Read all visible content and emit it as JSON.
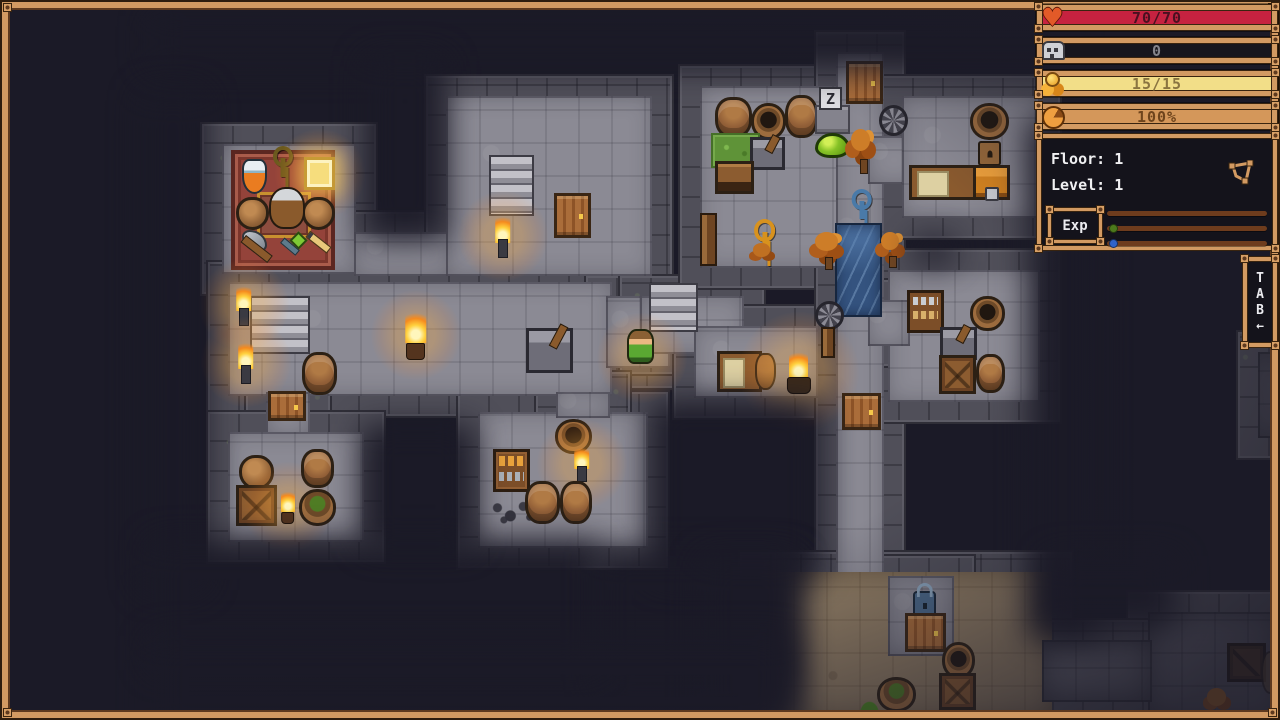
{
  "hud": {
    "bars": [
      {
        "id": "health-bar",
        "icon": "heart-icon",
        "label": "70/70",
        "fill": "#c62240",
        "text": "#4a1020"
      },
      {
        "id": "skull-bar",
        "icon": "skull-icon",
        "label": "0",
        "fill": "#17161d",
        "text": "#84848a"
      },
      {
        "id": "gold-bar",
        "icon": "coins-icon",
        "label": "15/15",
        "fill": "#f2de88",
        "text": "#8a7440"
      },
      {
        "id": "satiety-bar",
        "icon": "food-icon",
        "label": "100%",
        "fill": "#d4975a",
        "text": "#6e441c"
      }
    ],
    "info": {
      "floor": "Floor: 1",
      "level": "Level: 1",
      "exp": "Exp",
      "exp_rows": [
        {
          "dot": null
        },
        {
          "dot": "#4c7a1c"
        },
        {
          "dot": "#2f63c9"
        }
      ]
    },
    "tab": {
      "letters": [
        "T",
        "A",
        "B"
      ],
      "arrow": "←"
    }
  },
  "map": {
    "floors": [
      {
        "x": 222,
        "y": 144,
        "w": 134,
        "h": 130,
        "tone": "light"
      },
      {
        "x": 354,
        "y": 232,
        "w": 96,
        "h": 44,
        "tone": "light"
      },
      {
        "x": 446,
        "y": 96,
        "w": 206,
        "h": 180,
        "tone": "light"
      },
      {
        "x": 228,
        "y": 282,
        "w": 384,
        "h": 114,
        "tone": "light"
      },
      {
        "x": 266,
        "y": 392,
        "w": 44,
        "h": 44,
        "tone": "light"
      },
      {
        "x": 228,
        "y": 432,
        "w": 136,
        "h": 110,
        "tone": "light"
      },
      {
        "x": 606,
        "y": 296,
        "w": 64,
        "h": 72,
        "tone": "light"
      },
      {
        "x": 640,
        "y": 296,
        "w": 104,
        "h": 58,
        "tone": "light"
      },
      {
        "x": 694,
        "y": 326,
        "w": 124,
        "h": 72,
        "tone": "light"
      },
      {
        "x": 700,
        "y": 86,
        "w": 170,
        "h": 182,
        "tone": "light"
      },
      {
        "x": 836,
        "y": 52,
        "w": 48,
        "h": 544,
        "tone": "light"
      },
      {
        "x": 868,
        "y": 136,
        "w": 52,
        "h": 48,
        "tone": "light"
      },
      {
        "x": 902,
        "y": 96,
        "w": 138,
        "h": 122,
        "tone": "light"
      },
      {
        "x": 888,
        "y": 270,
        "w": 152,
        "h": 132,
        "tone": "light"
      },
      {
        "x": 868,
        "y": 300,
        "w": 42,
        "h": 46,
        "tone": "light"
      },
      {
        "x": 478,
        "y": 412,
        "w": 170,
        "h": 136,
        "tone": "light"
      },
      {
        "x": 556,
        "y": 392,
        "w": 54,
        "h": 26,
        "tone": "light"
      },
      {
        "x": 760,
        "y": 572,
        "w": 292,
        "h": 148,
        "tone": "dirt"
      },
      {
        "x": 888,
        "y": 576,
        "w": 66,
        "h": 80,
        "tone": "light"
      },
      {
        "x": 1148,
        "y": 612,
        "w": 132,
        "h": 108,
        "tone": "dim"
      },
      {
        "x": 1042,
        "y": 640,
        "w": 110,
        "h": 62,
        "tone": "dim"
      },
      {
        "x": 1258,
        "y": 352,
        "w": 22,
        "h": 86,
        "tone": "dim"
      }
    ],
    "objects": [
      {
        "type": "carpet",
        "x": 231,
        "y": 150,
        "w": 104,
        "h": 120
      },
      {
        "type": "mat",
        "x": 257,
        "y": 192,
        "w": 54,
        "h": 46
      },
      {
        "type": "keydark",
        "x": 272,
        "y": 146,
        "w": 22,
        "h": 32
      },
      {
        "type": "potion",
        "x": 242,
        "y": 159,
        "w": 25,
        "h": 35
      },
      {
        "type": "book",
        "x": 304,
        "y": 157,
        "w": 31,
        "h": 33
      },
      {
        "type": "pot",
        "x": 236,
        "y": 197,
        "w": 33,
        "h": 33
      },
      {
        "type": "pot",
        "x": 302,
        "y": 197,
        "w": 33,
        "h": 33
      },
      {
        "type": "npc",
        "x": 269,
        "y": 187,
        "w": 36,
        "h": 42
      },
      {
        "type": "axe",
        "x": 242,
        "y": 230,
        "w": 35,
        "h": 33
      },
      {
        "type": "wand",
        "x": 278,
        "y": 234,
        "w": 25,
        "h": 29
      },
      {
        "type": "pencil",
        "x": 304,
        "y": 232,
        "w": 29,
        "h": 31
      },
      {
        "type": "stairs",
        "x": 250,
        "y": 296,
        "w": 60,
        "h": 58
      },
      {
        "type": "torch",
        "x": 233,
        "y": 283,
        "w": 21,
        "h": 43
      },
      {
        "type": "torch",
        "x": 235,
        "y": 339,
        "w": 21,
        "h": 45
      },
      {
        "type": "candle",
        "x": 401,
        "y": 309,
        "w": 29,
        "h": 51
      },
      {
        "type": "lever",
        "x": 526,
        "y": 328,
        "w": 47,
        "h": 45
      },
      {
        "type": "barrel",
        "x": 302,
        "y": 352,
        "w": 35,
        "h": 43
      },
      {
        "type": "door",
        "x": 268,
        "y": 391,
        "w": 38,
        "h": 30
      },
      {
        "type": "pot",
        "x": 239,
        "y": 455,
        "w": 35,
        "h": 35
      },
      {
        "type": "crate2",
        "x": 236,
        "y": 485,
        "w": 41,
        "h": 41
      },
      {
        "type": "candle",
        "x": 278,
        "y": 489,
        "w": 19,
        "h": 35
      },
      {
        "type": "barrel",
        "x": 301,
        "y": 449,
        "w": 33,
        "h": 39
      },
      {
        "type": "potplant",
        "x": 299,
        "y": 489,
        "w": 37,
        "h": 37
      },
      {
        "type": "stairs",
        "x": 489,
        "y": 155,
        "w": 45,
        "h": 61
      },
      {
        "type": "door",
        "x": 554,
        "y": 193,
        "w": 37,
        "h": 45
      },
      {
        "type": "torch",
        "x": 492,
        "y": 213,
        "w": 21,
        "h": 45
      },
      {
        "type": "barrel",
        "x": 715,
        "y": 97,
        "w": 37,
        "h": 41
      },
      {
        "type": "potopen",
        "x": 751,
        "y": 103,
        "w": 35,
        "h": 37
      },
      {
        "type": "barrel",
        "x": 785,
        "y": 95,
        "w": 33,
        "h": 43
      },
      {
        "type": "grass",
        "x": 711,
        "y": 133,
        "w": 49,
        "h": 35
      },
      {
        "type": "lever",
        "x": 750,
        "y": 137,
        "w": 35,
        "h": 33
      },
      {
        "type": "chestwood",
        "x": 715,
        "y": 161,
        "w": 39,
        "h": 33
      },
      {
        "type": "slab",
        "x": 815,
        "y": 105,
        "w": 35,
        "h": 29
      },
      {
        "type": "zsign",
        "x": 819,
        "y": 87,
        "w": 23,
        "h": 23,
        "label": "Z"
      },
      {
        "type": "slime",
        "x": 815,
        "y": 133,
        "w": 35,
        "h": 25
      },
      {
        "type": "tree",
        "x": 843,
        "y": 125,
        "w": 37,
        "h": 49
      },
      {
        "type": "door",
        "x": 846,
        "y": 61,
        "w": 37,
        "h": 43
      },
      {
        "type": "windmill",
        "x": 879,
        "y": 105,
        "w": 29,
        "h": 31
      },
      {
        "type": "post",
        "x": 700,
        "y": 213,
        "w": 17,
        "h": 53
      },
      {
        "type": "keygold",
        "x": 752,
        "y": 219,
        "w": 25,
        "h": 35
      },
      {
        "type": "bush",
        "x": 744,
        "y": 239,
        "w": 35,
        "h": 27
      },
      {
        "type": "keyblue",
        "x": 850,
        "y": 189,
        "w": 23,
        "h": 31
      },
      {
        "type": "water",
        "x": 835,
        "y": 223,
        "w": 47,
        "h": 94
      },
      {
        "type": "tree",
        "x": 805,
        "y": 229,
        "w": 45,
        "h": 41
      },
      {
        "type": "tree",
        "x": 873,
        "y": 229,
        "w": 35,
        "h": 39
      },
      {
        "type": "potopen",
        "x": 970,
        "y": 103,
        "w": 39,
        "h": 37
      },
      {
        "type": "chestsmall",
        "x": 978,
        "y": 141,
        "w": 23,
        "h": 25
      },
      {
        "type": "bench",
        "x": 909,
        "y": 165,
        "w": 69,
        "h": 35
      },
      {
        "type": "chest",
        "x": 973,
        "y": 165,
        "w": 37,
        "h": 35
      },
      {
        "type": "bookshelf",
        "x": 907,
        "y": 290,
        "w": 37,
        "h": 43
      },
      {
        "type": "potopen",
        "x": 970,
        "y": 296,
        "w": 35,
        "h": 35
      },
      {
        "type": "lever",
        "x": 940,
        "y": 327,
        "w": 37,
        "h": 33
      },
      {
        "type": "crate2",
        "x": 939,
        "y": 355,
        "w": 37,
        "h": 39
      },
      {
        "type": "barrel",
        "x": 976,
        "y": 354,
        "w": 29,
        "h": 39
      },
      {
        "type": "stairs",
        "x": 649,
        "y": 283,
        "w": 49,
        "h": 49
      },
      {
        "type": "glowitem",
        "x": 631,
        "y": 351,
        "w": 21,
        "h": 13
      },
      {
        "type": "player",
        "x": 627,
        "y": 329,
        "w": 27,
        "h": 35
      },
      {
        "type": "bench",
        "x": 717,
        "y": 351,
        "w": 45,
        "h": 41
      },
      {
        "type": "jug",
        "x": 755,
        "y": 353,
        "w": 21,
        "h": 37
      },
      {
        "type": "brazier",
        "x": 785,
        "y": 349,
        "w": 27,
        "h": 45
      },
      {
        "type": "windmill",
        "x": 815,
        "y": 301,
        "w": 29,
        "h": 29
      },
      {
        "type": "post",
        "x": 821,
        "y": 327,
        "w": 14,
        "h": 31
      },
      {
        "type": "door",
        "x": 842,
        "y": 393,
        "w": 39,
        "h": 37
      },
      {
        "type": "potopen",
        "x": 555,
        "y": 419,
        "w": 37,
        "h": 35
      },
      {
        "type": "torch",
        "x": 571,
        "y": 445,
        "w": 21,
        "h": 37
      },
      {
        "type": "shelf",
        "x": 493,
        "y": 449,
        "w": 37,
        "h": 43
      },
      {
        "type": "rubble",
        "x": 491,
        "y": 497,
        "w": 43,
        "h": 27
      },
      {
        "type": "barrel",
        "x": 525,
        "y": 481,
        "w": 35,
        "h": 43
      },
      {
        "type": "barrel",
        "x": 560,
        "y": 481,
        "w": 32,
        "h": 43
      },
      {
        "type": "padlock",
        "x": 913,
        "y": 591,
        "w": 23,
        "h": 27
      },
      {
        "type": "door",
        "x": 905,
        "y": 613,
        "w": 41,
        "h": 39
      },
      {
        "type": "potopen",
        "x": 942,
        "y": 642,
        "w": 33,
        "h": 37
      },
      {
        "type": "crate2",
        "x": 939,
        "y": 673,
        "w": 37,
        "h": 37
      },
      {
        "type": "potplant",
        "x": 877,
        "y": 677,
        "w": 39,
        "h": 35
      },
      {
        "type": "tuft",
        "x": 858,
        "y": 699,
        "w": 23,
        "h": 15
      },
      {
        "type": "tuft",
        "x": 938,
        "y": 711,
        "w": 25,
        "h": 9
      },
      {
        "type": "cratedark",
        "x": 1227,
        "y": 643,
        "w": 39,
        "h": 39
      },
      {
        "type": "bush",
        "x": 1197,
        "y": 683,
        "w": 39,
        "h": 35
      },
      {
        "type": "potdim",
        "x": 1261,
        "y": 651,
        "w": 19,
        "h": 43
      }
    ],
    "fog": [
      {
        "x": 150,
        "y": 16,
        "w": 920,
        "h": 52
      },
      {
        "x": 140,
        "y": 90,
        "w": 66,
        "h": 500
      },
      {
        "x": 364,
        "y": 56,
        "w": 82,
        "h": 184
      },
      {
        "x": 150,
        "y": 540,
        "w": 450,
        "h": 130
      },
      {
        "x": 362,
        "y": 424,
        "w": 112,
        "h": 124
      },
      {
        "x": 650,
        "y": 400,
        "w": 170,
        "h": 180
      },
      {
        "x": 596,
        "y": 552,
        "w": 200,
        "h": 140
      },
      {
        "x": 1028,
        "y": 120,
        "w": 70,
        "h": 520
      },
      {
        "x": 700,
        "y": 556,
        "w": 100,
        "h": 170
      },
      {
        "x": 150,
        "y": 636,
        "w": 640,
        "h": 100
      },
      {
        "x": 1046,
        "y": 556,
        "w": 130,
        "h": 72
      },
      {
        "x": 914,
        "y": 238,
        "w": 40,
        "h": 26
      }
    ]
  }
}
